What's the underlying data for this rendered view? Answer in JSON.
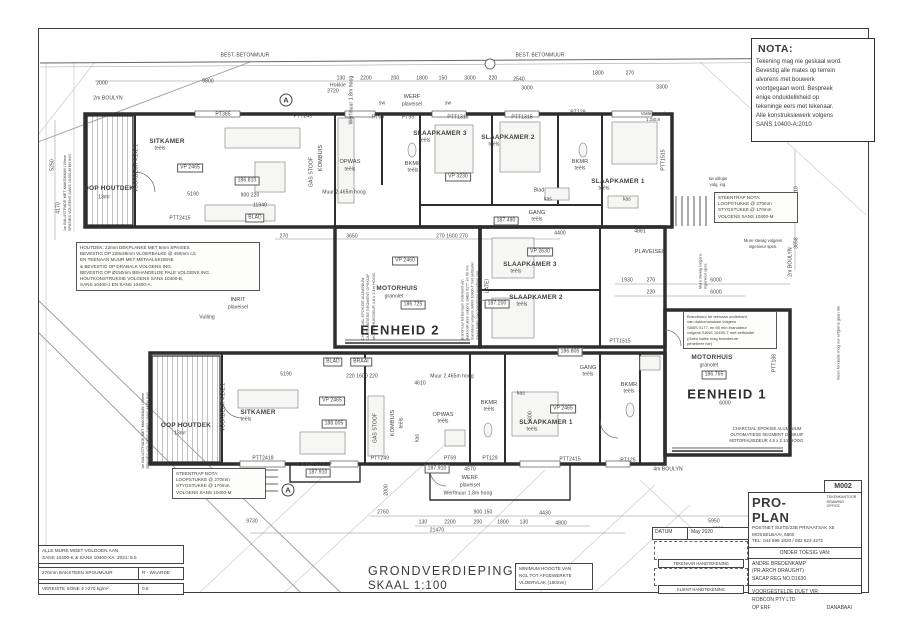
{
  "meta": {
    "drawing_title": "GRONDVERDIEPING",
    "scale": "SKAAL 1:100",
    "sheet_no": "M002"
  },
  "nota": {
    "title": "NOTA:",
    "lines": [
      "Tekening mag nie geskaal word.",
      "Bevestig alle mates op terrein",
      "alvorens met bouwerk",
      "voortgegaan word.  Bespreek",
      "enige onduidelikheid op",
      "tekeninge eers met tekenaar.",
      "Alle konstruksiewerk volgens",
      "SANS 10400-A:2010"
    ]
  },
  "footer": {
    "title": "GRONDVERDIEPING",
    "scale": "SKAAL 1:100"
  },
  "min_hoogte": {
    "lines": [
      "MINIMUM HOOGTE VAN",
      "NGL TOT AFGEWERKTE",
      "VLOERVLAK (150mm)"
    ]
  },
  "wall_table": {
    "header_lines": [
      "ALLE MURE MOET VOLDOEN AAN",
      "SANS 10400-K & SANS 10400-XA: 2021: 5.5"
    ],
    "row1_left": "270mm BAKSTEEN SPOUMUUR",
    "row1_right": "R - WAARDE",
    "row2_left": "VEREISTE SONE 4   >270 kg/m²",
    "row2_right": "0.6"
  },
  "title_block": {
    "sheet_no": "M002",
    "firm": "PRO-PLAN",
    "firm_sub1": "TEKENKANTOOR",
    "firm_sub2": "DRAWING OFFICE",
    "address1": "POSTNET SUITE/23B PRIVAATSAK X5",
    "address2": "MOSSELBAAI, 6500",
    "tel": "TEL: 044 696 1820 / 082 823 4272",
    "supervision": "ONDER TOESIG VAN:",
    "name": "ANDRE BREDENKAMP",
    "qual": "(PR.ARCH DRAUGHT)",
    "reg": "SACAP REG NO D1630",
    "proj1": "VOORGESTELDE DUET VIR",
    "proj2": "ROBCON PTY LTD",
    "proj3a": "OP ERF",
    "proj3b": "DANABAAI",
    "datum_label": "DATUM",
    "datum_value": "May 2020",
    "sig1": "TEKENAAR HANDTEKENING",
    "sig2": "KLIENT HANDTEKENING"
  },
  "plan": {
    "notes": [
      {
        "name": "houtdek-note",
        "x": 76,
        "y": 242,
        "w": 176,
        "size": 4.6,
        "boxed": true,
        "lines": [
          "HOUTDEK: 22mm DEKPLANKE MET 5mm SPASIES",
          "BEVESTIG OP 228x38mm VLOERBALKE @ 450mm c/c",
          "EN TEENAAN MUUR MET METAALSKOENE",
          "& BEVESTIG OP DRABALK VOLGENS ING.",
          "BEVESTIG OP Ø150mm BEHANDELDE PALE VOLGENS ING.",
          "HOUTKONSTRUKSIE VOLGENS SANS 10400-B,",
          "SANS 10400-J EN SANS 10400-A."
        ]
      },
      {
        "name": "steentrap-note-left",
        "x": 172,
        "y": 468,
        "w": 86,
        "size": 4.6,
        "boxed": true,
        "lines": [
          "STEENTRAP NOTA:",
          "LOOPSTUKKE @ 270mm",
          "STYGSTUKKE @ 170mm",
          "VOLGENS SANS 10400-M"
        ]
      },
      {
        "name": "steentrap-note-right",
        "x": 714,
        "y": 192,
        "w": 76,
        "size": 4.6,
        "boxed": true,
        "lines": [
          "STEENTRAP NOTA:",
          "LOOPSTUKKE @ 270mm",
          "STYGSTUKKE @ 170mm",
          "VOLGENS SANS 10400-M"
        ]
      },
      {
        "name": "brandmuur-note-unit1",
        "x": 683,
        "y": 311,
        "w": 86,
        "size": 4,
        "boxed": true,
        "lines": [
          "Brandmuur tot teenaan onderkant",
          "van dakkonstruksie volgens",
          "SABS 0177, en 60 min branddeur",
          "volgens SANS 10400-T met selfsluiter",
          "(Geen balke mag brandmure",
          "penetreer nie)"
        ]
      },
      {
        "name": "brandmuur-note-unit2",
        "x": 470,
        "y": 288,
        "w": 104,
        "size": 3.6,
        "rot": -90,
        "lines": [
          "Brandmuur tot teenaan onderkant van",
          "dakkonstruksie volgens SABS 0177, en 60 min",
          "branddeur volgens SANS 10400-T met selfsluiter",
          "(Geen balke mag brandmure penetreer nie)"
        ]
      },
      {
        "name": "charcoal-note-unit2",
        "x": 368,
        "y": 290,
        "w": 100,
        "size": 3.9,
        "rot": -90,
        "lines": [
          "CHARCOAL EPOKSIE ALUMINIUM",
          "OUTOMATIESE SEGMENT OPSKUIF",
          "MOTORHUISDEUR 4.8 x 2.1m HOOG."
        ]
      },
      {
        "name": "charcoal-note-unit1",
        "x": 707,
        "y": 426,
        "w": 120,
        "size": 4.3,
        "rot": 0,
        "center": true,
        "lines": [
          "CHARCOAL EPOKSIE ALUMINIUM",
          "OUTOMATIESE SEGMENT OPSKUIF",
          "MOTORHUISDEUR 4.8 x 2.1m HOOG."
        ]
      },
      {
        "name": "mure-stewig-note",
        "x": 733,
        "y": 238,
        "w": 60,
        "size": 4.2,
        "center": true,
        "lines": [
          "Mure stewig volgens",
          "ingenieur spes."
        ]
      },
      {
        "name": "mure-stewig-note-vert",
        "x": 703,
        "y": 263,
        "w": 52,
        "size": 3.9,
        "rot": -90,
        "lines": [
          "Mure stewig volgens",
          "ingenieur spes."
        ]
      },
      {
        "name": "vaste-paneel-note",
        "x": 633,
        "y": 111,
        "w": 40,
        "size": 4.2,
        "center": true,
        "lines": [
          "Vaste paneel",
          "1.2x0.8"
        ]
      },
      {
        "name": "sw-uitlope-note",
        "x": 699,
        "y": 176,
        "w": 38,
        "size": 4.2,
        "center": true,
        "lines": [
          "sw uitlope",
          "volg. ing."
        ]
      },
      {
        "name": "balustrade-note-top",
        "x": 68,
        "y": 172,
        "w": 118,
        "size": 3.8,
        "rot": -90,
        "lines": [
          "1m BALUSTRADE MET MAKSIMUM 100mm",
          "SPASIES VOLGENS SANS 10400-M EN ING."
        ]
      },
      {
        "name": "balustrade-note-bottom",
        "x": 146,
        "y": 410,
        "w": 118,
        "size": 3.8,
        "rot": -90,
        "lines": [
          "1m BALUSTRADE MET MAKSIMUM 100mm",
          "SPASIES VOLGENS SANS 10400-M EN ING."
        ]
      },
      {
        "name": "erfgrens-note",
        "x": 838,
        "y": 335,
        "w": 90,
        "size": 4,
        "rot": -90,
        "lines": [
          "Geen fondasie mag oor erfgrens gaan nie"
        ]
      }
    ],
    "labels": [
      {
        "t": "BEST. BETONMUUR",
        "x": 245,
        "y": 56
      },
      {
        "t": "BEST. BETONMUUR",
        "x": 540,
        "y": 56
      },
      {
        "t": "2000",
        "x": 102,
        "y": 84
      },
      {
        "t": "9800",
        "x": 208,
        "y": 82
      },
      {
        "t": "3720",
        "x": 333,
        "y": 92
      },
      {
        "t": "130",
        "x": 341,
        "y": 79
      },
      {
        "t": "2200",
        "x": 366,
        "y": 79
      },
      {
        "t": "200",
        "x": 395,
        "y": 79
      },
      {
        "t": "1800",
        "x": 422,
        "y": 79
      },
      {
        "t": "150",
        "x": 443,
        "y": 79
      },
      {
        "t": "3000",
        "x": 470,
        "y": 79
      },
      {
        "t": "220",
        "x": 493,
        "y": 79
      },
      {
        "t": "2540",
        "x": 519,
        "y": 80
      },
      {
        "t": "3000",
        "x": 527,
        "y": 89
      },
      {
        "t": "1800",
        "x": 598,
        "y": 74
      },
      {
        "t": "270",
        "x": 630,
        "y": 74
      },
      {
        "t": "3300",
        "x": 662,
        "y": 88
      },
      {
        "t": "2m BOULYN",
        "x": 108,
        "y": 99
      },
      {
        "t": "Hokkie",
        "x": 338,
        "y": 86
      },
      {
        "t": "WERF",
        "x": 412,
        "y": 98,
        "c": "s"
      },
      {
        "t": "plaveisel",
        "x": 412,
        "y": 105
      },
      {
        "t": "sw",
        "x": 382,
        "y": 104
      },
      {
        "t": "sw",
        "x": 448,
        "y": 104
      },
      {
        "t": "Werfmuur 1.8m hoog",
        "x": 352,
        "y": 100,
        "r": -90
      },
      {
        "t": "PT365",
        "x": 223,
        "y": 115
      },
      {
        "t": "PTT249",
        "x": 303,
        "y": 117
      },
      {
        "t": "PT69",
        "x": 378,
        "y": 118
      },
      {
        "t": "PT99",
        "x": 408,
        "y": 118
      },
      {
        "t": "PTT1315",
        "x": 458,
        "y": 118
      },
      {
        "t": "PTT1315",
        "x": 522,
        "y": 118
      },
      {
        "t": "PT129",
        "x": 578,
        "y": 113
      },
      {
        "t": "PTT1515",
        "x": 664,
        "y": 160,
        "r": -90
      },
      {
        "t": "OOP HOUTDEK",
        "x": 109,
        "y": 189,
        "c": "r"
      },
      {
        "t": "13m²",
        "x": 104,
        "y": 198
      },
      {
        "t": "SITKAMER",
        "x": 167,
        "y": 142,
        "c": "r"
      },
      {
        "t": "teëls",
        "x": 160,
        "y": 149
      },
      {
        "t": "VP 2465",
        "x": 190,
        "y": 168,
        "c": "box"
      },
      {
        "t": "186.810",
        "x": 247,
        "y": 181,
        "c": "box"
      },
      {
        "t": "5190",
        "x": 193,
        "y": 195
      },
      {
        "t": "900 220",
        "x": 250,
        "y": 196
      },
      {
        "t": "11940",
        "x": 260,
        "y": 206
      },
      {
        "t": "PTT2415",
        "x": 180,
        "y": 219
      },
      {
        "t": "BLAD",
        "x": 255,
        "y": 218,
        "c": "box"
      },
      {
        "t": "VOORDEUR 4.2x2.1",
        "x": 137,
        "y": 168,
        "r": -90
      },
      {
        "t": "KOMBUIS",
        "x": 322,
        "y": 158,
        "r": -90,
        "c": "s"
      },
      {
        "t": "GAS STOOF",
        "x": 312,
        "y": 172,
        "r": -90
      },
      {
        "t": "OPWAS",
        "x": 350,
        "y": 163,
        "c": "s"
      },
      {
        "t": "teëls",
        "x": 350,
        "y": 170
      },
      {
        "t": "Muur 2.465m hoog",
        "x": 344,
        "y": 193
      },
      {
        "t": "BKMR",
        "x": 413,
        "y": 165,
        "c": "s"
      },
      {
        "t": "teëls",
        "x": 413,
        "y": 171
      },
      {
        "t": "SLAAPKAMER 3",
        "x": 440,
        "y": 134,
        "c": "r"
      },
      {
        "t": "teëls",
        "x": 425,
        "y": 141
      },
      {
        "t": "VP 3230",
        "x": 458,
        "y": 177,
        "c": "box"
      },
      {
        "t": "SLAAPKAMER 2",
        "x": 508,
        "y": 138,
        "c": "r"
      },
      {
        "t": "teëls",
        "x": 494,
        "y": 145
      },
      {
        "t": "BKMR",
        "x": 580,
        "y": 163,
        "c": "s"
      },
      {
        "t": "teëls",
        "x": 580,
        "y": 169
      },
      {
        "t": "SLAAPKAMER 1",
        "x": 618,
        "y": 182,
        "c": "r"
      },
      {
        "t": "teëls",
        "x": 604,
        "y": 189
      },
      {
        "t": "GANG",
        "x": 537,
        "y": 214,
        "c": "s"
      },
      {
        "t": "teëls",
        "x": 537,
        "y": 220
      },
      {
        "t": "187.490",
        "x": 506,
        "y": 221,
        "c": "box"
      },
      {
        "t": "Blad",
        "x": 539,
        "y": 191
      },
      {
        "t": "kas",
        "x": 548,
        "y": 200
      },
      {
        "t": "kas",
        "x": 627,
        "y": 200
      },
      {
        "t": "270",
        "x": 284,
        "y": 237
      },
      {
        "t": "3650",
        "x": 352,
        "y": 237
      },
      {
        "t": "270 1600 270",
        "x": 452,
        "y": 237
      },
      {
        "t": "4400",
        "x": 560,
        "y": 234
      },
      {
        "t": "4881",
        "x": 640,
        "y": 232
      },
      {
        "t": "INRIT",
        "x": 238,
        "y": 301,
        "c": "s"
      },
      {
        "t": "plaveisel",
        "x": 238,
        "y": 308
      },
      {
        "t": "Vulling",
        "x": 207,
        "y": 318
      },
      {
        "t": "VP 2460",
        "x": 405,
        "y": 261,
        "c": "box"
      },
      {
        "t": "MOTORHUIS",
        "x": 397,
        "y": 289,
        "c": "r"
      },
      {
        "t": "granolet",
        "x": 394,
        "y": 297
      },
      {
        "t": "186.725",
        "x": 413,
        "y": 305,
        "c": "box"
      },
      {
        "t": "EENHEID 2",
        "x": 400,
        "y": 330,
        "c": "b"
      },
      {
        "t": "LATEI",
        "x": 488,
        "y": 286,
        "r": -90
      },
      {
        "t": "187.200",
        "x": 497,
        "y": 304,
        "c": "box"
      },
      {
        "t": "SLAAPKAMER 3",
        "x": 530,
        "y": 265,
        "c": "r"
      },
      {
        "t": "teëls",
        "x": 516,
        "y": 272
      },
      {
        "t": "VP 2630",
        "x": 540,
        "y": 252,
        "c": "box"
      },
      {
        "t": "SLAAPKAMER 2",
        "x": 536,
        "y": 298,
        "c": "r"
      },
      {
        "t": "teëls",
        "x": 522,
        "y": 305
      },
      {
        "t": "PTT1515",
        "x": 620,
        "y": 342
      },
      {
        "t": "186.805",
        "x": 570,
        "y": 352,
        "c": "box"
      },
      {
        "t": "PLAVEISEL",
        "x": 650,
        "y": 253,
        "c": "s"
      },
      {
        "t": "1930",
        "x": 627,
        "y": 281
      },
      {
        "t": "270",
        "x": 651,
        "y": 281
      },
      {
        "t": "6000",
        "x": 716,
        "y": 281
      },
      {
        "t": "220",
        "x": 651,
        "y": 293
      },
      {
        "t": "6000",
        "x": 716,
        "y": 293
      },
      {
        "t": "2m BOULYN",
        "x": 791,
        "y": 262,
        "r": -90
      },
      {
        "t": "4710",
        "x": 797,
        "y": 192,
        "r": -90
      },
      {
        "t": "3658",
        "x": 797,
        "y": 243,
        "r": -90
      },
      {
        "t": "MOTORHUIS",
        "x": 712,
        "y": 358,
        "c": "r"
      },
      {
        "t": "granolet",
        "x": 709,
        "y": 366
      },
      {
        "t": "186.765",
        "x": 714,
        "y": 375,
        "c": "box"
      },
      {
        "t": "EENHEID 1",
        "x": 727,
        "y": 394,
        "c": "b"
      },
      {
        "t": "6000",
        "x": 725,
        "y": 404
      },
      {
        "t": "PTT188",
        "x": 775,
        "y": 363,
        "r": -90
      },
      {
        "t": "4m BOULYN",
        "x": 668,
        "y": 470
      },
      {
        "t": "OOP HOUTDEK",
        "x": 186,
        "y": 426,
        "c": "r"
      },
      {
        "t": "13m²",
        "x": 180,
        "y": 434
      },
      {
        "t": "VOORDEUR 4.2x2.1",
        "x": 224,
        "y": 407,
        "r": -90
      },
      {
        "t": "SITKAMER",
        "x": 258,
        "y": 413,
        "c": "r"
      },
      {
        "t": "teëls",
        "x": 246,
        "y": 420
      },
      {
        "t": "VP 2465",
        "x": 332,
        "y": 401,
        "c": "box"
      },
      {
        "t": "188.005",
        "x": 334,
        "y": 424,
        "c": "box"
      },
      {
        "t": "5190",
        "x": 286,
        "y": 375
      },
      {
        "t": "BLAD",
        "x": 333,
        "y": 362,
        "c": "box"
      },
      {
        "t": "BRAAI",
        "x": 361,
        "y": 362,
        "c": "box"
      },
      {
        "t": "220 1600 220",
        "x": 362,
        "y": 377
      },
      {
        "t": "GAS STOOF",
        "x": 376,
        "y": 428,
        "r": -90
      },
      {
        "t": "KOMBUIS",
        "x": 394,
        "y": 423,
        "r": -90,
        "c": "s"
      },
      {
        "t": "teëls",
        "x": 402,
        "y": 423,
        "r": -90
      },
      {
        "t": "OPWAS",
        "x": 443,
        "y": 416,
        "c": "s"
      },
      {
        "t": "teëls",
        "x": 443,
        "y": 422
      },
      {
        "t": "Muur 2.465m hoog",
        "x": 452,
        "y": 377
      },
      {
        "t": "4610",
        "x": 420,
        "y": 384
      },
      {
        "t": "kas",
        "x": 418,
        "y": 438,
        "r": -90
      },
      {
        "t": "BKMR",
        "x": 489,
        "y": 404,
        "c": "s"
      },
      {
        "t": "teëls",
        "x": 489,
        "y": 410
      },
      {
        "t": "SLAAPKAMER 1",
        "x": 546,
        "y": 423,
        "c": "r"
      },
      {
        "t": "teëls",
        "x": 532,
        "y": 430
      },
      {
        "t": "VP 2465",
        "x": 563,
        "y": 409,
        "c": "box"
      },
      {
        "t": "3600",
        "x": 531,
        "y": 417,
        "r": -90
      },
      {
        "t": "kas",
        "x": 521,
        "y": 394
      },
      {
        "t": "BKMR",
        "x": 629,
        "y": 386,
        "c": "s"
      },
      {
        "t": "teëls",
        "x": 629,
        "y": 392
      },
      {
        "t": "GANG",
        "x": 588,
        "y": 369,
        "c": "s"
      },
      {
        "t": "teëls",
        "x": 588,
        "y": 375
      },
      {
        "t": "PTT2418",
        "x": 263,
        "y": 459
      },
      {
        "t": "PTT249",
        "x": 380,
        "y": 459
      },
      {
        "t": "PT69",
        "x": 450,
        "y": 459
      },
      {
        "t": "PT129",
        "x": 490,
        "y": 459
      },
      {
        "t": "PTT2415",
        "x": 570,
        "y": 460
      },
      {
        "t": "PT125",
        "x": 628,
        "y": 461
      },
      {
        "t": "OOP STOEP",
        "x": 315,
        "y": 466,
        "c": "s"
      },
      {
        "t": "187.910",
        "x": 318,
        "y": 473,
        "c": "box"
      },
      {
        "t": "187.910",
        "x": 437,
        "y": 469,
        "c": "box"
      },
      {
        "t": "4570",
        "x": 470,
        "y": 470
      },
      {
        "t": "WERF",
        "x": 470,
        "y": 479,
        "c": "s"
      },
      {
        "t": "plaveisel",
        "x": 470,
        "y": 486
      },
      {
        "t": "Werfmuur 1.8m hoog",
        "x": 468,
        "y": 494
      },
      {
        "t": "2000",
        "x": 387,
        "y": 490,
        "r": -90
      },
      {
        "t": "2760",
        "x": 383,
        "y": 513
      },
      {
        "t": "900 150",
        "x": 483,
        "y": 513
      },
      {
        "t": "4430",
        "x": 545,
        "y": 514
      },
      {
        "t": "9730",
        "x": 252,
        "y": 522
      },
      {
        "t": "130",
        "x": 423,
        "y": 523
      },
      {
        "t": "2200",
        "x": 450,
        "y": 523
      },
      {
        "t": "200",
        "x": 478,
        "y": 523
      },
      {
        "t": "1800",
        "x": 503,
        "y": 523
      },
      {
        "t": "130",
        "x": 524,
        "y": 523
      },
      {
        "t": "4800",
        "x": 561,
        "y": 524
      },
      {
        "t": "21470",
        "x": 437,
        "y": 531
      },
      {
        "t": "5950",
        "x": 714,
        "y": 522
      },
      {
        "t": "6200",
        "x": 718,
        "y": 530
      },
      {
        "t": "5250",
        "x": 53,
        "y": 165,
        "r": -90
      },
      {
        "t": "4170",
        "x": 59,
        "y": 208,
        "r": -90
      },
      {
        "t": "A",
        "x": 286,
        "y": 100,
        "c": "mk"
      },
      {
        "t": "A",
        "x": 288,
        "y": 490,
        "c": "mk"
      }
    ]
  }
}
